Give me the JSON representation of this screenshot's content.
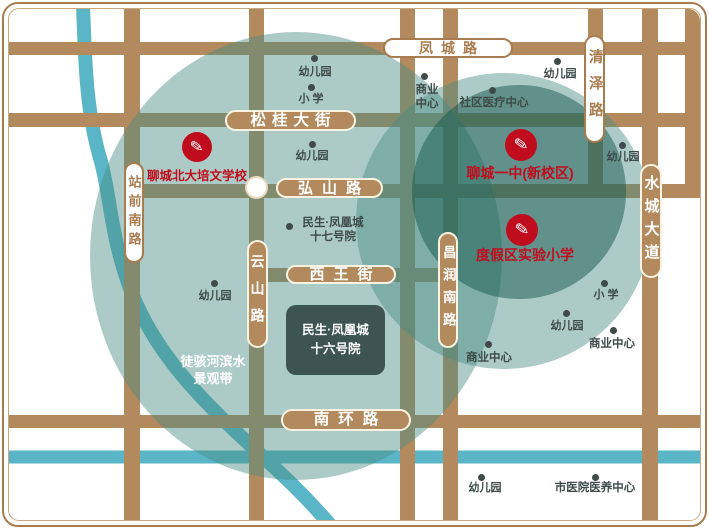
{
  "map": {
    "project_box": {
      "line1": "民生·凤凰城",
      "line2": "十六号院"
    },
    "badges": [
      {
        "label": "凤城路",
        "style": "light",
        "orientation": "horizontal"
      },
      {
        "label": "松桂大街",
        "style": "brown",
        "orientation": "horizontal"
      },
      {
        "label": "弘山路",
        "style": "brown",
        "orientation": "horizontal"
      },
      {
        "label": "西王街",
        "style": "brown",
        "orientation": "horizontal"
      },
      {
        "label": "南环路",
        "style": "brown",
        "orientation": "horizontal"
      },
      {
        "label": "站前南路",
        "style": "light",
        "orientation": "vertical"
      },
      {
        "label": "云山路",
        "style": "brown",
        "orientation": "vertical"
      },
      {
        "label": "昌润南路",
        "style": "brown",
        "orientation": "vertical"
      },
      {
        "label": "清泽路",
        "style": "light",
        "orientation": "vertical"
      },
      {
        "label": "水城大道",
        "style": "brown",
        "orientation": "vertical"
      }
    ],
    "schools": [
      {
        "label": "聊城北大培文学校",
        "icon": "pencil-icon",
        "glyph": "✎"
      },
      {
        "label": "聊城一中(新校区)",
        "icon": "pencil-icon",
        "glyph": "✎"
      },
      {
        "label": "度假区实验小学",
        "icon": "pencil-icon",
        "glyph": "✎"
      }
    ],
    "pois": [
      {
        "lines": [
          "幼儿园"
        ]
      },
      {
        "lines": [
          "小 学"
        ]
      },
      {
        "lines": [
          "幼儿园"
        ]
      },
      {
        "lines": [
          "民生·凤凰城",
          "十七号院"
        ]
      },
      {
        "lines": [
          "商业",
          "中心"
        ]
      },
      {
        "lines": [
          "社区医疗中心"
        ]
      },
      {
        "lines": [
          "幼儿园"
        ]
      },
      {
        "lines": [
          "幼儿园"
        ]
      },
      {
        "lines": [
          "小 学"
        ]
      },
      {
        "lines": [
          "幼儿园"
        ]
      },
      {
        "lines": [
          "商业中心"
        ]
      },
      {
        "lines": [
          "商业中心"
        ]
      },
      {
        "lines": [
          "幼儿园"
        ]
      },
      {
        "lines": [
          "幼儿园"
        ]
      },
      {
        "lines": [
          "市医院医养中心"
        ]
      }
    ],
    "river_label": {
      "line1": "徒骇河滨水",
      "line2": "景观带"
    },
    "colors": {
      "road": "#b28a5d",
      "badge_brown_text": "#ffffff",
      "badge_light_text": "#a87c4f",
      "school_red": "#c00d1e",
      "river_blue": "#5ab6c6",
      "teal_light": "rgba(70,140,128,0.45)",
      "teal_dark": "rgba(22,88,78,0.50)",
      "poi_text": "#3e4b48",
      "project_box_bg": "#3d5450"
    }
  }
}
